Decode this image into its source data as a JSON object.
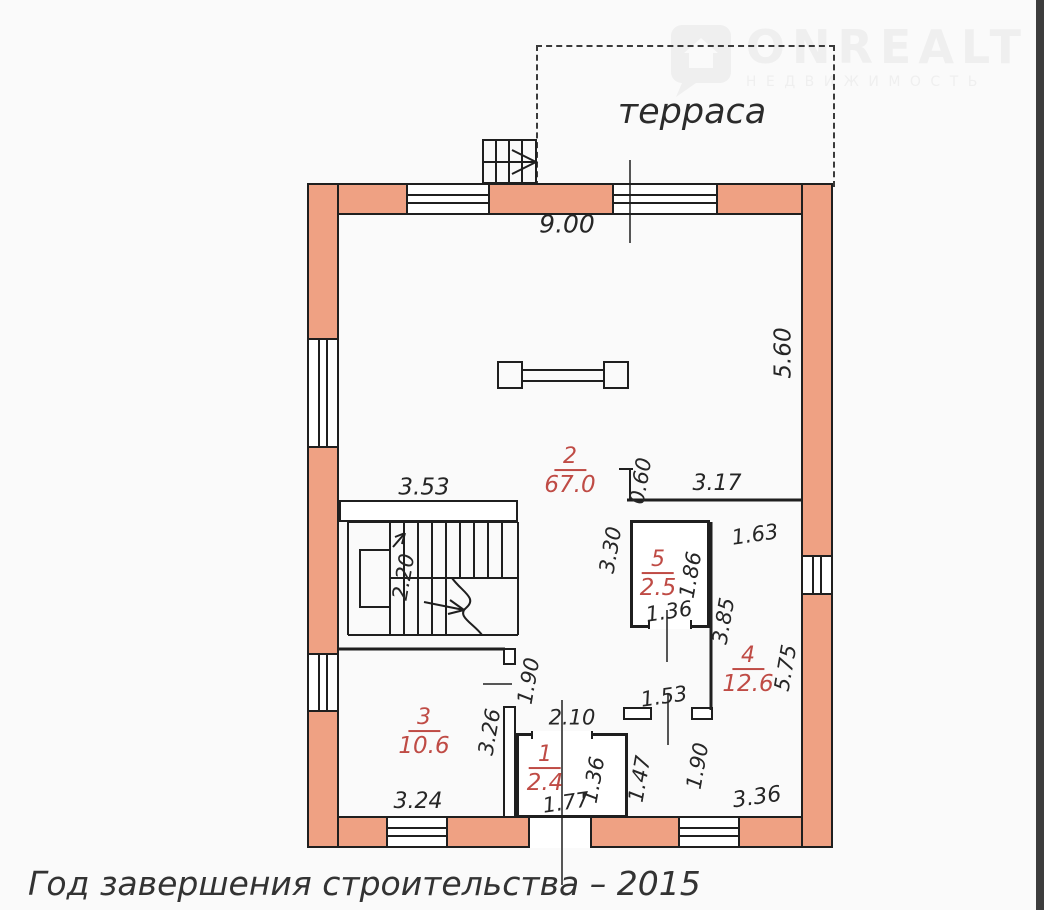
{
  "logo": {
    "brand": "ONREALT",
    "subtitle": "НЕДВИЖИМОСТЬ"
  },
  "terrace_label": "терраса",
  "caption": "Год завершения строительства – 2015",
  "rooms": [
    {
      "num": "2",
      "area": "67.0",
      "x": 570,
      "y": 472
    },
    {
      "num": "5",
      "area": "2.5",
      "x": 658,
      "y": 575
    },
    {
      "num": "4",
      "area": "12.6",
      "x": 748,
      "y": 671
    },
    {
      "num": "3",
      "area": "10.6",
      "x": 424,
      "y": 733
    },
    {
      "num": "1",
      "area": "2.4",
      "x": 545,
      "y": 770
    }
  ],
  "dimensions": [
    {
      "value": "9.00",
      "x": 567,
      "y": 224,
      "rot": 0,
      "size": 25
    },
    {
      "value": "5.60",
      "x": 784,
      "y": 353,
      "rot": -90,
      "size": 23
    },
    {
      "value": "3.53",
      "x": 424,
      "y": 488,
      "rot": 0,
      "size": 23
    },
    {
      "value": "0.60",
      "x": 641,
      "y": 481,
      "rot": -80,
      "size": 21
    },
    {
      "value": "3.17",
      "x": 717,
      "y": 484,
      "rot": 0,
      "size": 22
    },
    {
      "value": "2.20",
      "x": 404,
      "y": 577,
      "rot": -80,
      "size": 21
    },
    {
      "value": "3.30",
      "x": 611,
      "y": 550,
      "rot": -80,
      "size": 21
    },
    {
      "value": "1.86",
      "x": 691,
      "y": 575,
      "rot": -80,
      "size": 21
    },
    {
      "value": "1.63",
      "x": 755,
      "y": 535,
      "rot": -8,
      "size": 21
    },
    {
      "value": "1.36",
      "x": 669,
      "y": 612,
      "rot": -8,
      "size": 21
    },
    {
      "value": "3.85",
      "x": 724,
      "y": 621,
      "rot": -80,
      "size": 21
    },
    {
      "value": "5.75",
      "x": 786,
      "y": 668,
      "rot": -80,
      "size": 21
    },
    {
      "value": "1.90",
      "x": 529,
      "y": 681,
      "rot": -80,
      "size": 21
    },
    {
      "value": "3.26",
      "x": 490,
      "y": 732,
      "rot": -80,
      "size": 21
    },
    {
      "value": "2.10",
      "x": 572,
      "y": 718,
      "rot": 0,
      "size": 21
    },
    {
      "value": "1.53",
      "x": 664,
      "y": 697,
      "rot": -8,
      "size": 21
    },
    {
      "value": "1.47",
      "x": 640,
      "y": 779,
      "rot": -80,
      "size": 21
    },
    {
      "value": "1.90",
      "x": 698,
      "y": 766,
      "rot": -80,
      "size": 21
    },
    {
      "value": "1.36",
      "x": 594,
      "y": 780,
      "rot": -80,
      "size": 21
    },
    {
      "value": "1.77",
      "x": 566,
      "y": 803,
      "rot": -8,
      "size": 21
    },
    {
      "value": "3.24",
      "x": 418,
      "y": 802,
      "rot": 0,
      "size": 22
    },
    {
      "value": "3.36",
      "x": 757,
      "y": 798,
      "rot": -8,
      "size": 22
    }
  ],
  "colors": {
    "wall_fill": "#efa183",
    "line": "#1f1f1f",
    "room_label": "#bf4b45"
  }
}
